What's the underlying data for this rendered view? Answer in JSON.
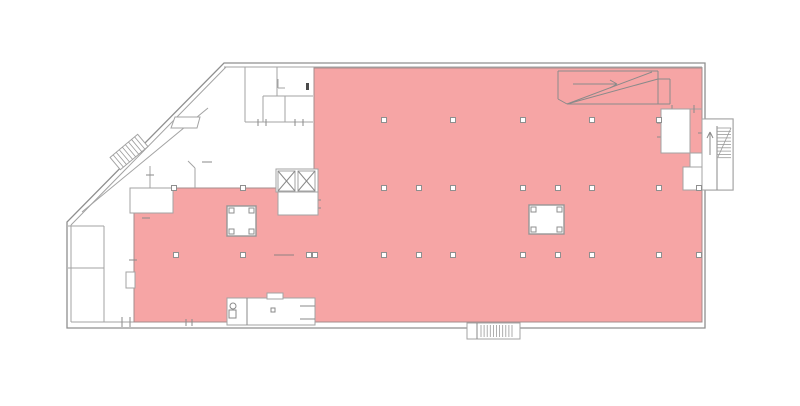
{
  "meta": {
    "title": "Building floor plan with highlighted lettable area"
  },
  "canvas": {
    "width": 800,
    "height": 406
  },
  "colors": {
    "background": "#ffffff",
    "highlight": "#f6a5a5",
    "highlight_edge": "#a58c8c",
    "wall": "#a3a3a3",
    "outline": "#8f8f8f",
    "tick": "#8a8a8a",
    "white": "#ffffff",
    "dark_detail": "#4a4a4a"
  },
  "plan": {
    "outline": {
      "outer_path": "M224,63 L705,63 L705,119 L733,119 L733,190 L705,190 L705,328 L67,328 L67,222 Z",
      "inner_walls": [
        [
          224,
          67,
          702,
          67
        ],
        [
          702,
          67,
          702,
          119
        ],
        [
          702,
          190,
          702,
          322
        ],
        [
          71,
          322,
          702,
          322
        ],
        [
          71,
          225,
          71,
          322
        ],
        [
          226,
          67,
          71,
          225
        ]
      ]
    },
    "highlight": {
      "points": "314,68 702,68 702,322 134,322 134,213 173,213 173,188 314,188"
    },
    "walls": [
      [
        245,
        67,
        245,
        122
      ],
      [
        245,
        122,
        313,
        122
      ],
      [
        277,
        67,
        277,
        96
      ],
      [
        263,
        96,
        313,
        96
      ],
      [
        263,
        96,
        263,
        122
      ],
      [
        285,
        96,
        285,
        122
      ],
      [
        278,
        79,
        278,
        88
      ],
      [
        278,
        88,
        285,
        88
      ],
      [
        208,
        108,
        82,
        212
      ],
      [
        150,
        166,
        150,
        188
      ],
      [
        195,
        168,
        195,
        188
      ],
      [
        188,
        161,
        195,
        168
      ],
      [
        104,
        226,
        104,
        322
      ],
      [
        68,
        268,
        104,
        268
      ],
      [
        68,
        226,
        104,
        226
      ],
      [
        690,
        109,
        702,
        109
      ]
    ],
    "ticks": [
      [
        258,
        119,
        258,
        126
      ],
      [
        266,
        119,
        266,
        126
      ],
      [
        295,
        119,
        295,
        126
      ],
      [
        303,
        119,
        303,
        126
      ],
      [
        146,
        175,
        154,
        175
      ],
      [
        142,
        218,
        150,
        218
      ],
      [
        122,
        317,
        122,
        327
      ],
      [
        130,
        317,
        130,
        327
      ],
      [
        129,
        260,
        137,
        260
      ],
      [
        186,
        319,
        186,
        326
      ],
      [
        192,
        319,
        192,
        326
      ],
      [
        313,
        200,
        321,
        200
      ],
      [
        313,
        208,
        321,
        208
      ],
      [
        698,
        133,
        706,
        133
      ],
      [
        698,
        172,
        706,
        172
      ],
      [
        698,
        183,
        706,
        183
      ],
      [
        694,
        105,
        694,
        113
      ],
      [
        672,
        105,
        672,
        113
      ],
      [
        657,
        123,
        665,
        123
      ],
      [
        657,
        137,
        665,
        137
      ],
      [
        202,
        162,
        212,
        162
      ]
    ],
    "dash": [
      274,
      255,
      294,
      255
    ],
    "strip_rect": "171,128 175,117 200,117 197,128",
    "door_block": [
      306,
      83,
      3,
      7
    ],
    "rooms": [
      {
        "name": "room-top-right-white",
        "x": 661,
        "y": 109,
        "w": 29,
        "h": 44
      },
      {
        "name": "right-wall-patch-upper",
        "x": 690,
        "y": 153,
        "w": 12,
        "h": 14
      },
      {
        "name": "right-wall-patch-lower",
        "x": 683,
        "y": 167,
        "w": 19,
        "h": 23
      },
      {
        "name": "room-left-white",
        "x": 130,
        "y": 188,
        "w": 43,
        "h": 25
      },
      {
        "name": "left-wall-notch",
        "x": 126,
        "y": 272,
        "w": 9,
        "h": 16
      },
      {
        "name": "vestibule",
        "x": 227,
        "y": 298,
        "w": 88,
        "h": 27
      },
      {
        "name": "vestibule-notch",
        "x": 267,
        "y": 293,
        "w": 16,
        "h": 6
      }
    ],
    "vestibule": {
      "lines": [
        [
          247,
          298,
          247,
          325
        ],
        [
          300,
          306,
          315,
          306
        ],
        [
          300,
          319,
          315,
          319
        ]
      ],
      "circle": [
        233,
        306,
        3
      ],
      "fixture": [
        229,
        310,
        7,
        8
      ],
      "square": [
        271,
        308,
        4,
        4
      ]
    },
    "cores": {
      "size": 5,
      "boxes": [
        [
          227,
          206,
          29,
          30
        ],
        [
          529,
          205,
          35,
          29
        ]
      ]
    },
    "markers": {
      "size": 5,
      "rows": [
        {
          "y": 120,
          "xs": [
            384,
            453,
            523,
            592,
            659
          ]
        },
        {
          "y": 188,
          "xs": [
            174,
            243,
            384,
            419,
            453,
            523,
            558,
            592,
            659,
            699
          ]
        },
        {
          "y": 255,
          "xs": [
            176,
            243,
            309,
            315,
            384,
            419,
            453,
            523,
            558,
            592,
            659,
            699
          ]
        }
      ]
    },
    "elevators": {
      "block": [
        276,
        169,
        42,
        23
      ],
      "cars": [
        [
          278,
          171,
          17,
          20
        ],
        [
          298,
          171,
          17,
          20
        ]
      ],
      "lobby": [
        278,
        192,
        40,
        23
      ]
    },
    "stair_right": {
      "outer": [
        702,
        119,
        31,
        71
      ],
      "divider": [
        717,
        126,
        717,
        190
      ],
      "tread_x": [
        717,
        731
      ],
      "tread_y": [
        128,
        158
      ],
      "tread_step": 3.3,
      "diag": [
        731,
        128,
        718,
        157
      ],
      "arrow_shaft": [
        710,
        155,
        710,
        132
      ],
      "arrow_head": [
        [
          710,
          132,
          707,
          138
        ],
        [
          710,
          132,
          713,
          138
        ]
      ]
    },
    "stair_bottom": {
      "rect": [
        467,
        323,
        53,
        16
      ],
      "divider": [
        477,
        323,
        477,
        339
      ],
      "hatch_x": [
        481,
        515
      ],
      "hatch_step": 3.1,
      "hatch_y": [
        325,
        337
      ]
    },
    "stair_diagonal": {
      "cx": 129,
      "cy": 152,
      "w": 36,
      "h": 16,
      "angle": -40,
      "step": 4
    },
    "ramp": {
      "lines": [
        [
          558,
          71,
          658,
          71
        ],
        [
          558,
          71,
          558,
          99
        ],
        [
          558,
          99,
          567,
          104
        ],
        [
          567,
          104,
          652,
          72
        ],
        [
          567,
          104,
          658,
          79
        ],
        [
          658,
          71,
          658,
          104
        ],
        [
          567,
          104,
          670,
          104
        ],
        [
          658,
          79,
          670,
          79
        ],
        [
          670,
          79,
          670,
          104
        ]
      ],
      "arrow_shaft": [
        573,
        84,
        617,
        84
      ],
      "arrow_head": [
        [
          617,
          84,
          610,
          80
        ],
        [
          617,
          84,
          610,
          88
        ]
      ]
    }
  }
}
